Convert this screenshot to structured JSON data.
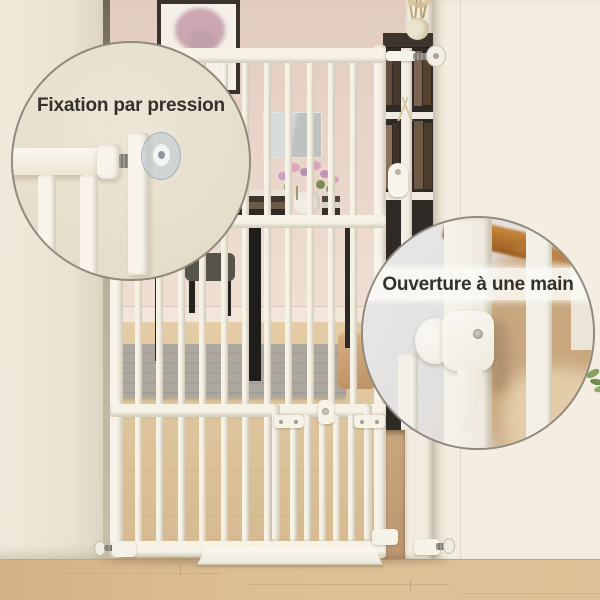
{
  "image_type": "product-marketing-photo",
  "callouts": {
    "pressure_mount": {
      "label": "Fixation par pression"
    },
    "one_hand_open": {
      "label": "Ouverture à une main"
    }
  },
  "icons": {
    "pressure_mount_icon": "tension-screw-with-wall-pad",
    "one_hand_open_icon": "gate-handle-latch"
  },
  "colors": {
    "gate_white": "#F6F2E6",
    "far_wall_pink": "#E7D4C9",
    "left_wall": "#EDE7D8",
    "right_wall": "#F3EEE1",
    "floor_wood": "#D9BB90",
    "rug_gray": "#ACA89F",
    "callout_bg": "#E9E2D2",
    "callout_border": "#8F8A7D",
    "caption_text": "#32312C"
  }
}
